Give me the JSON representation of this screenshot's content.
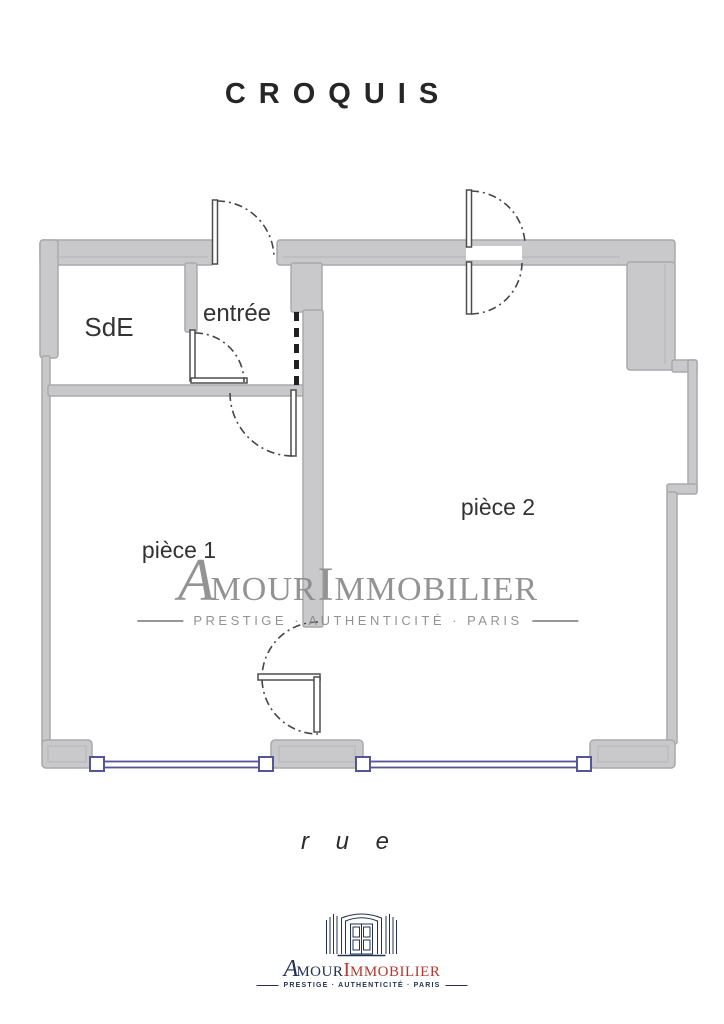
{
  "page": {
    "title": "CROQUIS",
    "street_label": "r u e"
  },
  "rooms": {
    "sde": "SdE",
    "entree": "entrée",
    "piece1": "pièce 1",
    "piece2": "pièce 2"
  },
  "watermark": {
    "word_a": "A",
    "word_mour": "MOUR",
    "word_i": "I",
    "word_mmobilier": "MMOBILIER",
    "tagline": "PRESTIGE · AUTHENTICITÉ · PARIS"
  },
  "logo": {
    "word_a": "A",
    "word_mour": "MOUR",
    "word_i": "I",
    "word_mmobilier": "MMOBILIER",
    "tagline": "PRESTIGE · AUTHENTICITÉ · PARIS"
  },
  "colors": {
    "wall_fill": "#c9c9cb",
    "wall_edge": "#a9a9ad",
    "door_line": "#4d4d4d",
    "door_arc": "#454545",
    "window": "#54549b",
    "watermark_gray": "#8a8a8a",
    "logo_navy": "#233253",
    "logo_red": "#b23a31",
    "title_color": "#262626"
  }
}
